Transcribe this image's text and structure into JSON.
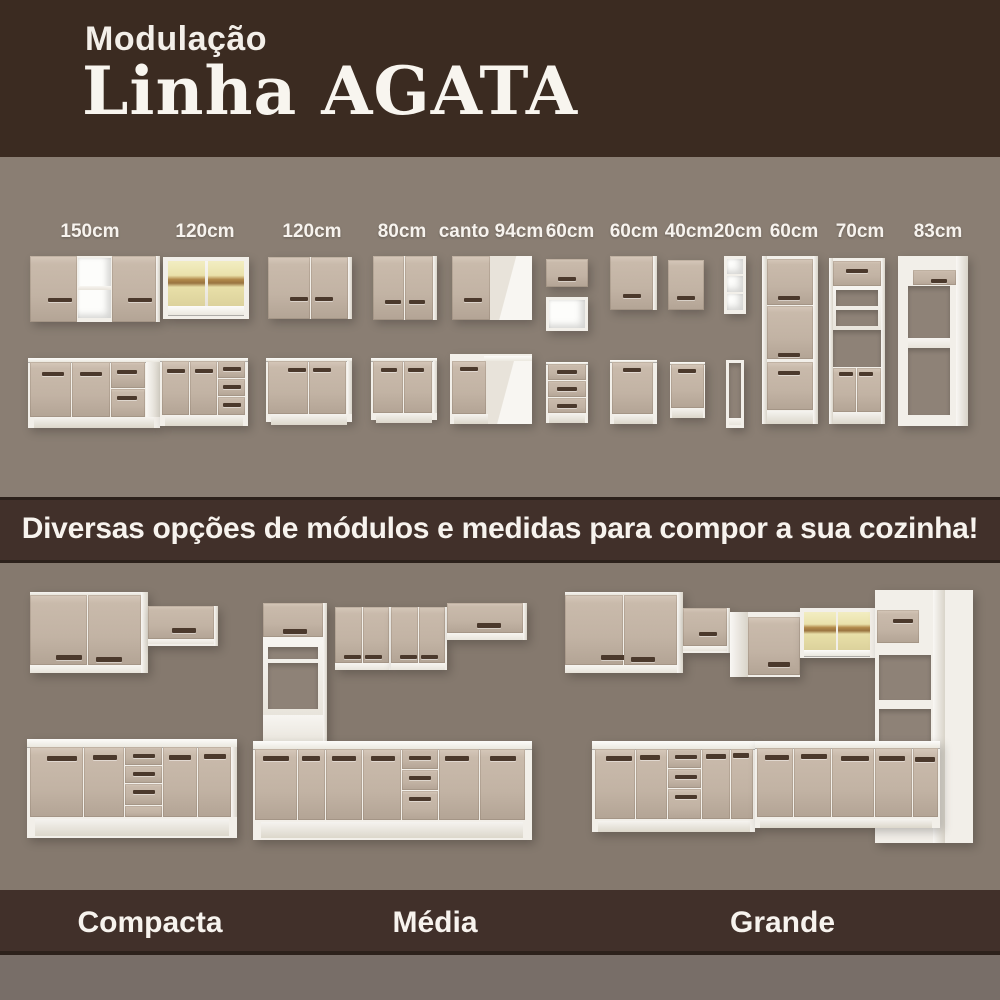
{
  "header": {
    "subtitle": "Modulação",
    "title": "Linha AGATA"
  },
  "modules": {
    "sizes": [
      {
        "label": "150cm"
      },
      {
        "label": "120cm"
      },
      {
        "label": "120cm"
      },
      {
        "label": "80cm"
      },
      {
        "label": "canto 94cm"
      },
      {
        "label": "60cm"
      },
      {
        "label": "60cm"
      },
      {
        "label": "40cm"
      },
      {
        "label": "20cm"
      },
      {
        "label": "60cm"
      },
      {
        "label": "70cm"
      },
      {
        "label": "83cm"
      }
    ]
  },
  "banner": {
    "text": "Diversas opções de módulos e medidas para compor a sua cozinha!"
  },
  "kitchens": {
    "items": [
      {
        "name": "Compacta"
      },
      {
        "name": "Média"
      },
      {
        "name": "Grande"
      }
    ]
  },
  "colors": {
    "header_bg": "#3b2b21",
    "band_bg": "#41302a",
    "modules_bg": "#8a7e73",
    "kitchens_bg": "#85796e",
    "bottom_strip_bg": "#786e68",
    "door_beige": "#c2b3a4",
    "carcass_white": "#f2efe9",
    "handle_brown": "#4b392c",
    "glass_yellow": "#eae2ab",
    "text_cream": "#f7f3ee"
  }
}
